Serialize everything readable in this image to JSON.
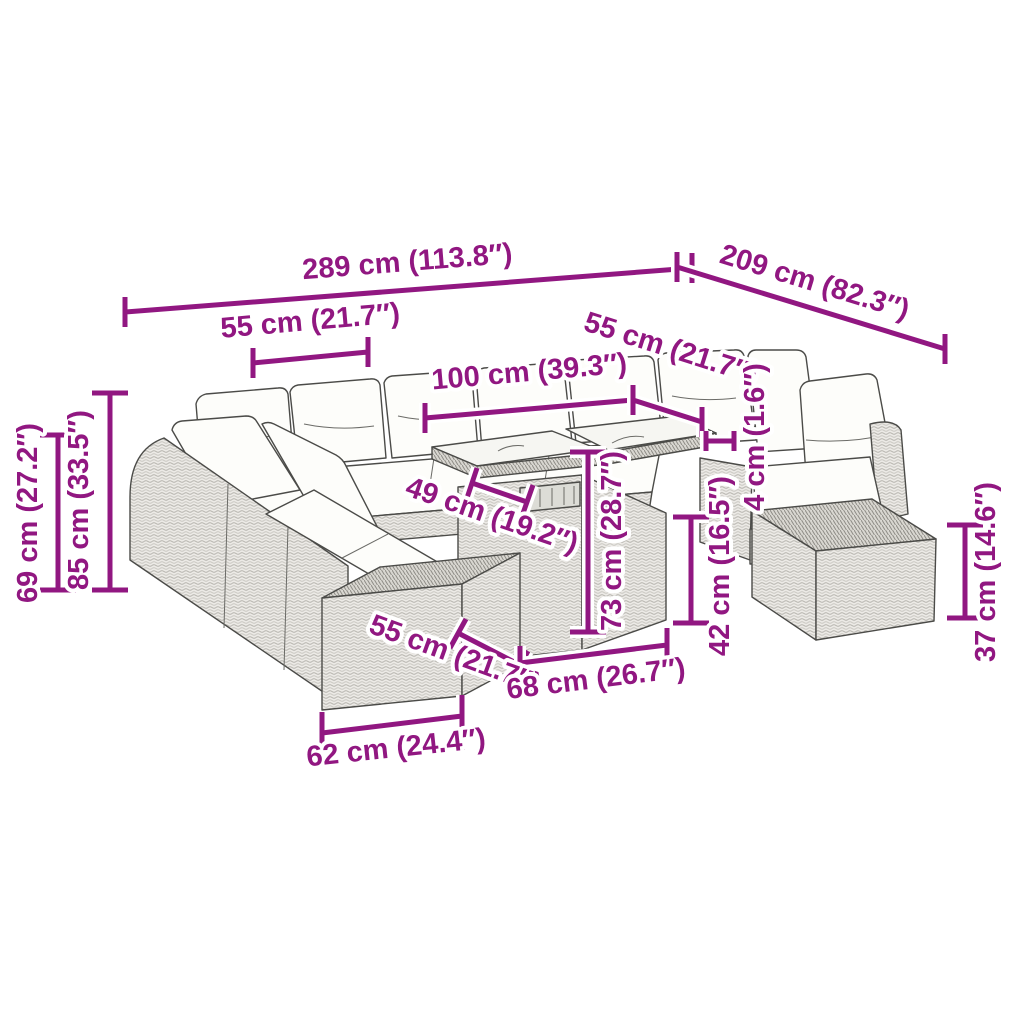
{
  "diagram": {
    "kind": "product-dimension-diagram",
    "subject": "rattan garden lounge set with footstools and glass-top table",
    "accent_color": "#911781",
    "line_art_color": "#4b4b48"
  },
  "dims": {
    "overall_width": "289 cm (113.8″)",
    "overall_depth": "209 cm (82.3″)",
    "back_seat_width": "55 cm (21.7″)",
    "table_length": "100 cm (39.3″)",
    "right_seat_width": "55 cm (21.7″)",
    "cushion_gap": "4 cm (1.6″)",
    "seat_back_height": "69 cm (27.2″)",
    "total_height": "85 cm (33.5″)",
    "table_top_depth": "49 cm (19.2″)",
    "table_height": "73 cm (28.7″)",
    "seat_height": "42 cm (16.5″)",
    "footstool_height": "37 cm (14.6″)",
    "footstool_depth": "55 cm (21.7″)",
    "table_base_width": "68 cm (26.7″)",
    "footstool_width": "62 cm (24.4″)"
  }
}
